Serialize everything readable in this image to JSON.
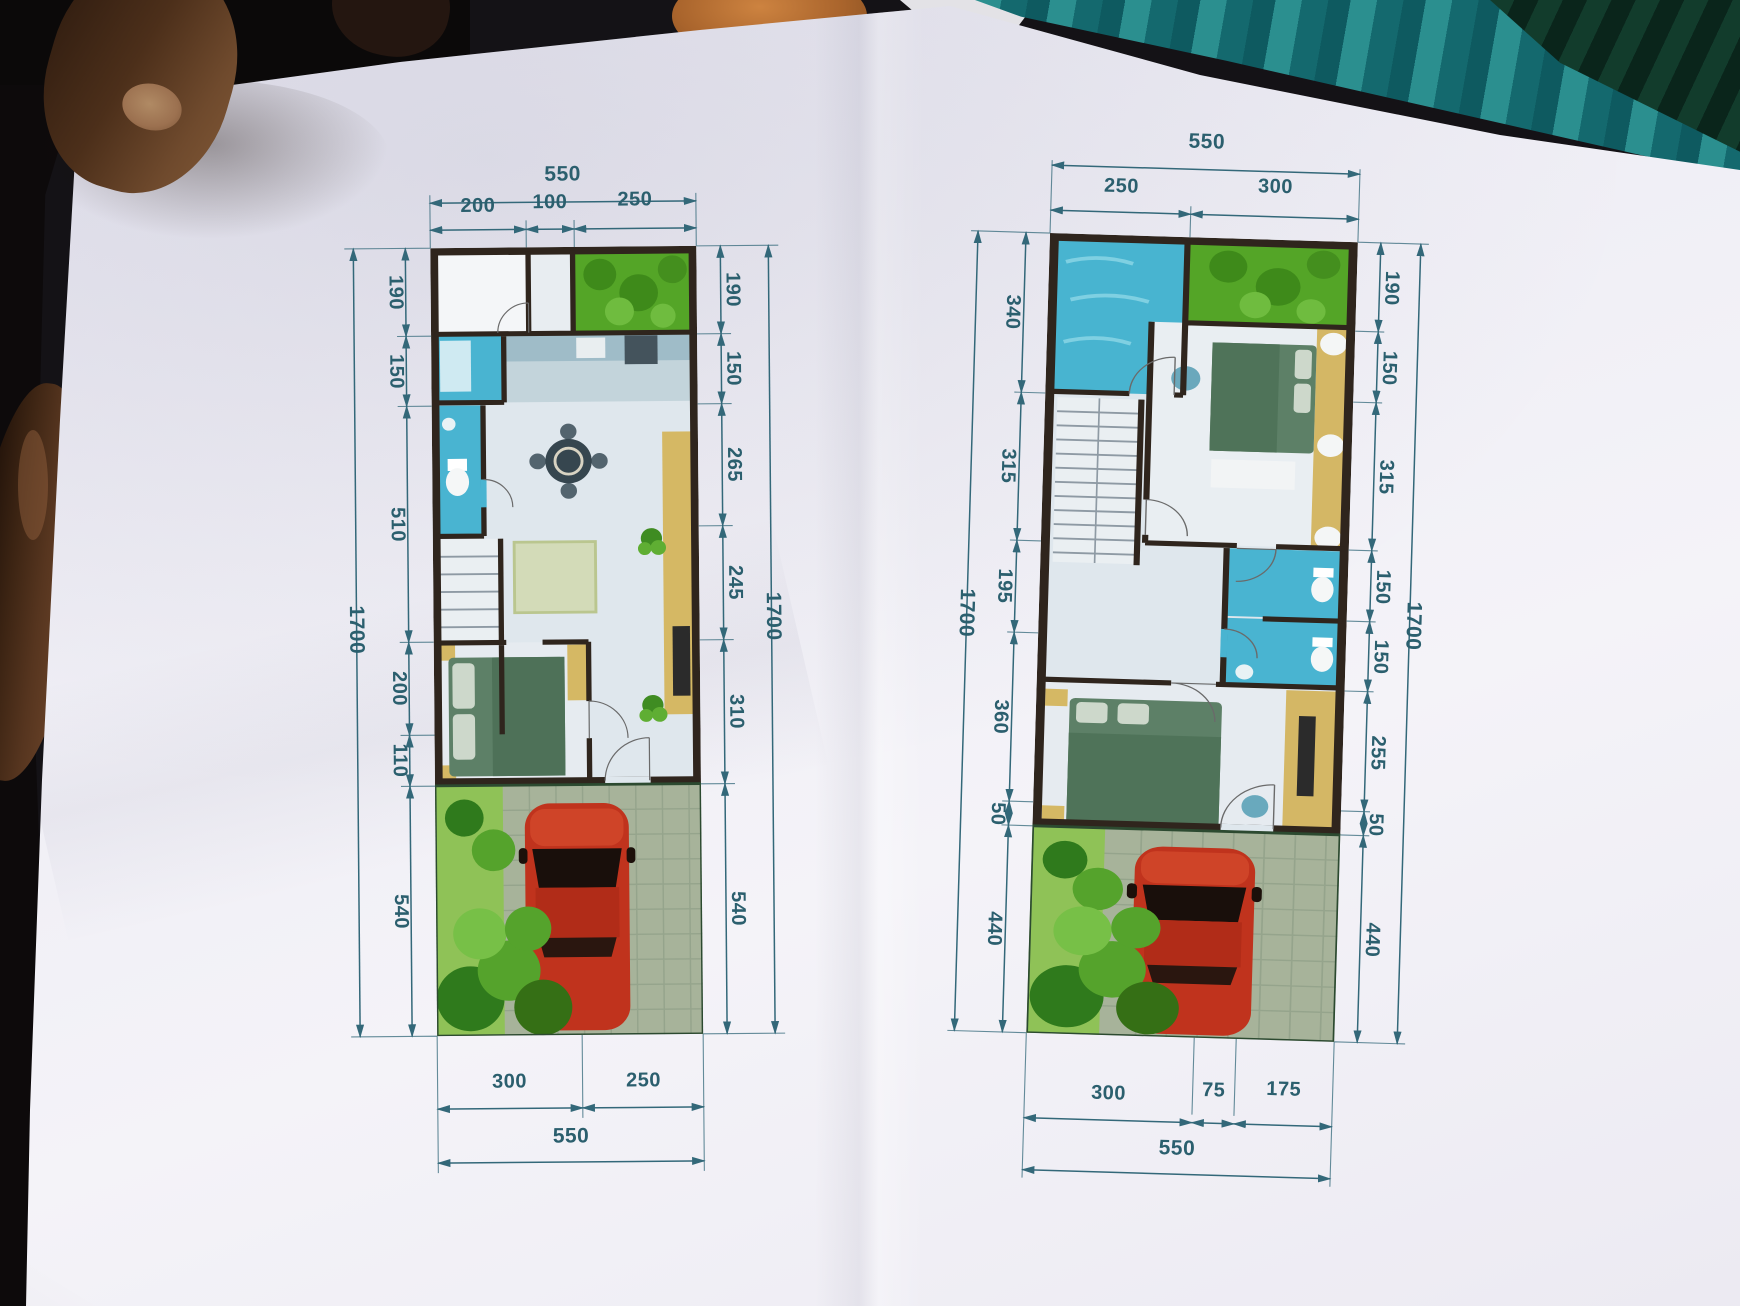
{
  "document": {
    "type": "two-storey house floor plans on photographed paper",
    "colors": {
      "dimension_ink": "#2b5f6e",
      "wall": "#2f251d",
      "wet_area_blue": "#49b4d1",
      "garden_green": "#54a527",
      "bed_green": "#5d8067",
      "furniture_yellow": "#d5b864",
      "car_red": "#c0331d",
      "paver_gray_green": "#a7b39a",
      "paper": "#efeef5"
    }
  },
  "plans": [
    {
      "id": "ground-floor",
      "dim_top_total": "550",
      "dim_top_segments": [
        "200",
        "100",
        "250"
      ],
      "dim_bottom_segments": [
        "300",
        "250"
      ],
      "dim_bottom_total": "550",
      "dim_left_segments": [
        "190",
        "150",
        "510",
        "200",
        "110",
        "540"
      ],
      "dim_left_overall": "1700",
      "dim_right_segments": [
        "190",
        "150",
        "265",
        "245",
        "310",
        "540"
      ],
      "dim_right_overall": "1700"
    },
    {
      "id": "upper-floor",
      "dim_top_total": "550",
      "dim_top_segments": [
        "250",
        "300"
      ],
      "dim_bottom_segments": [
        "300",
        "75",
        "175"
      ],
      "dim_bottom_total": "550",
      "dim_left_segments": [
        "340",
        "315",
        "195",
        "360",
        "50",
        "440"
      ],
      "dim_left_overall": "1700",
      "dim_right_segments": [
        "190",
        "150",
        "315",
        "150",
        "150",
        "255",
        "50",
        "440"
      ],
      "dim_right_overall": "1700"
    }
  ]
}
